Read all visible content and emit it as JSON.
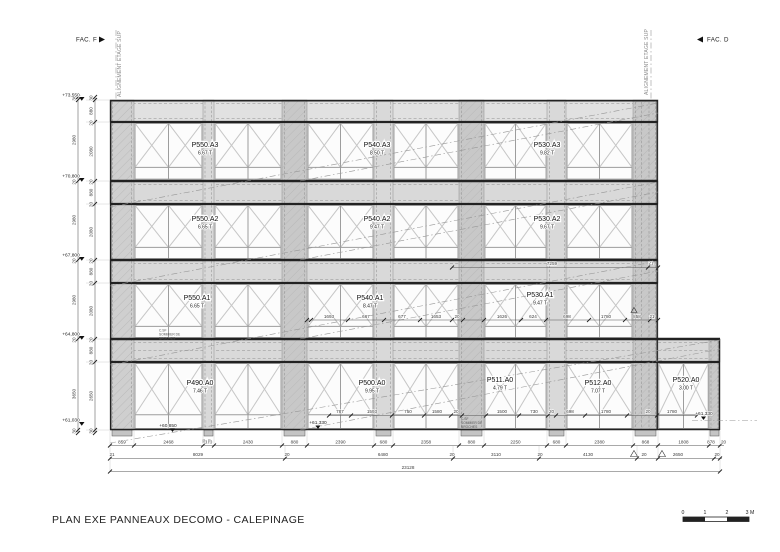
{
  "drawing_title": "PLAN EXE PANNEAUX DECOMO - CALEPINAGE",
  "facade_markers": {
    "left": "FAC. F",
    "right": "FAC. D"
  },
  "alignment_label": "ALIGNEMENT ETAGE SUP",
  "scale_bar": {
    "ticks": [
      "0",
      "1",
      "2"
    ],
    "end": "3 M"
  },
  "elevation_markers": {
    "left": [
      "+73,550",
      "+70,800",
      "+67,800",
      "+64,800",
      "+61,030"
    ],
    "bottom": [
      "+60,850",
      "+61,330"
    ],
    "right": "+61,330"
  },
  "panels": [
    {
      "id": "P550.A3",
      "weight": "6.67 T"
    },
    {
      "id": "P540.A3",
      "weight": "8.50 T"
    },
    {
      "id": "P530.A3",
      "weight": "9.82 T"
    },
    {
      "id": "P550.A2",
      "weight": "6.65 T"
    },
    {
      "id": "P540.A2",
      "weight": "9.47 T"
    },
    {
      "id": "P530.A2",
      "weight": "9.67 T"
    },
    {
      "id": "P550.A1",
      "weight": "6.65 T"
    },
    {
      "id": "P540.A1",
      "weight": "8.47 T"
    },
    {
      "id": "P530.A1",
      "weight": "9.47 T"
    },
    {
      "id": "P490.A0",
      "weight": "7.46 T"
    },
    {
      "id": "P500.A0",
      "weight": "9.95 T"
    },
    {
      "id": "P511.A0",
      "weight": "4.79 T"
    },
    {
      "id": "P512.A0",
      "weight": "7.07 T"
    },
    {
      "id": "P520.A0",
      "weight": "3.00 T"
    }
  ],
  "dimensions": {
    "left_outer": [
      "30",
      "2980",
      "20",
      "2980",
      "20",
      "2980",
      "20",
      "3650",
      "30"
    ],
    "left_inner": [
      "30",
      "880",
      "20",
      "2080",
      "20",
      "880",
      "20",
      "2080",
      "20",
      "880",
      "20",
      "2080",
      "20",
      "880",
      "20",
      "2650",
      "30"
    ],
    "bottom_row1": [
      "859",
      "2468",
      "380",
      "2430",
      "880",
      "2390",
      "680",
      "2358",
      "880",
      "2250",
      "680",
      "2380",
      "868",
      "1808",
      "878",
      "20"
    ],
    "bottom_row2": [
      "21",
      "8029",
      "20",
      "6480",
      "20",
      "3110",
      "20",
      "4130",
      "20",
      "2650",
      "20"
    ],
    "bottom_total": "23128",
    "level_a1": [
      "1693",
      "667",
      "677",
      "1653",
      "20",
      "1626",
      "624",
      "698",
      "1780",
      "858",
      "21"
    ],
    "band_a2_right": [
      "7259",
      "21"
    ],
    "level_a0": [
      "787",
      "1593",
      "750",
      "1580",
      "20",
      "1500",
      "730",
      "20",
      "698",
      "1780",
      "20",
      "1780"
    ],
    "pier_feet": [
      "50",
      "50"
    ]
  },
  "notes": {
    "note1": [
      "C.SF",
      "SOMMIER DE",
      "BROCHES"
    ],
    "note2": [
      "C.SF",
      "SOMMIER DE",
      "BROCHES"
    ]
  },
  "colors": {
    "band": "#e1e1e1",
    "band_lower": "#d9d9d9",
    "pier_dark": "#c8c8c8",
    "pier_light": "#d9d9d9",
    "pier_edge": "#cfcfcf",
    "window": "#fcfcfc"
  }
}
